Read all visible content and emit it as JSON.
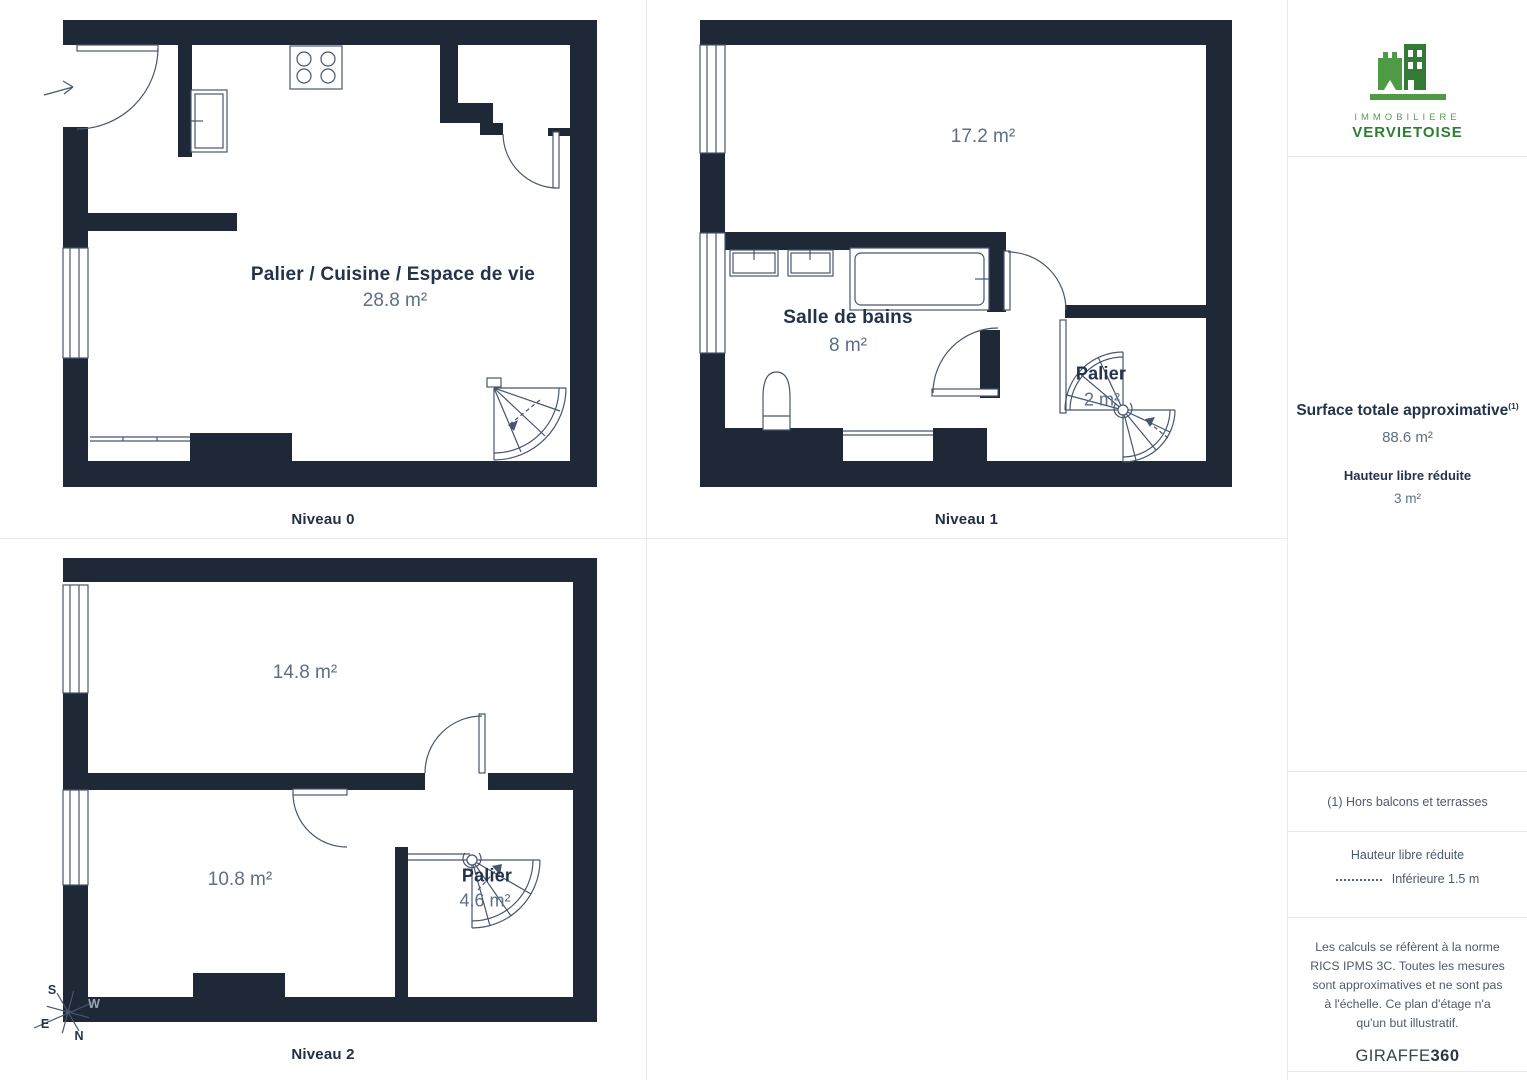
{
  "branding": {
    "line1": "IMMOBILIERE",
    "line2": "VERVIETOISE"
  },
  "levels": [
    {
      "name": "Niveau 0",
      "rooms": [
        {
          "label": "Palier / Cuisine / Espace de vie",
          "area": "28.8 m²"
        }
      ]
    },
    {
      "name": "Niveau 1",
      "rooms": [
        {
          "area": "17.2 m²"
        },
        {
          "label": "Salle de bains",
          "area": "8 m²"
        },
        {
          "label": "Palier",
          "area": "2 m²"
        }
      ]
    },
    {
      "name": "Niveau 2",
      "rooms": [
        {
          "area": "14.8 m²"
        },
        {
          "area": "10.8 m²"
        },
        {
          "label": "Palier",
          "area": "4.6 m²"
        }
      ]
    }
  ],
  "compass": {
    "n": "N",
    "s": "S",
    "e": "E",
    "w": "W"
  },
  "sidebar": {
    "surface_title": "Surface totale approximative",
    "surface_marker": "(1)",
    "surface_value": "88.6 m²",
    "reduced_title": "Hauteur libre réduite",
    "reduced_value": "3 m²",
    "footnote": "(1) Hors balcons et terrasses",
    "legend_title": "Hauteur libre réduite",
    "legend_value": "Inférieure 1.5 m",
    "disclaimer": "Les calculs se réfèrent à la norme RICS IPMS 3C. Toutes les mesures sont approximatives et ne sont pas à l'échelle. Ce plan d'étage n'a qu'un but illustratif.",
    "brand": "GIRAFFE",
    "brand_bold": "360"
  },
  "colors": {
    "wall": "#1e2836",
    "line": "#47566e",
    "green_light": "#4f9b45",
    "green_dark": "#337a36"
  }
}
